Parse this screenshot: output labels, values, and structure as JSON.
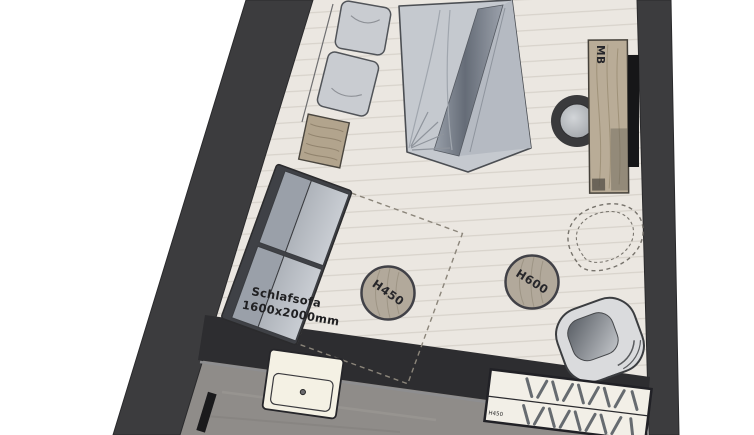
{
  "floorplan": {
    "type": "hotel-room-floor-plan",
    "labels": {
      "minibar": "MB",
      "sofa_line1": "Schlafsofa",
      "sofa_line2": "1600x2000mm",
      "pouf_h450": "H450",
      "pouf_h600": "H600",
      "sideboard_h450": "H450"
    },
    "colors": {
      "wall": "#3c3c3e",
      "floor": "#ebe7e1",
      "plank_line": "#d6d1c9",
      "wood": "#b7ab96",
      "bathroom_floor": "#8f8c89",
      "counter": "#2d2d30",
      "sink": "#f4f1e4",
      "duvet": "#c5c9cf",
      "sofa_fabric": "#bfc3c9",
      "hatch": "#4e545c"
    }
  }
}
